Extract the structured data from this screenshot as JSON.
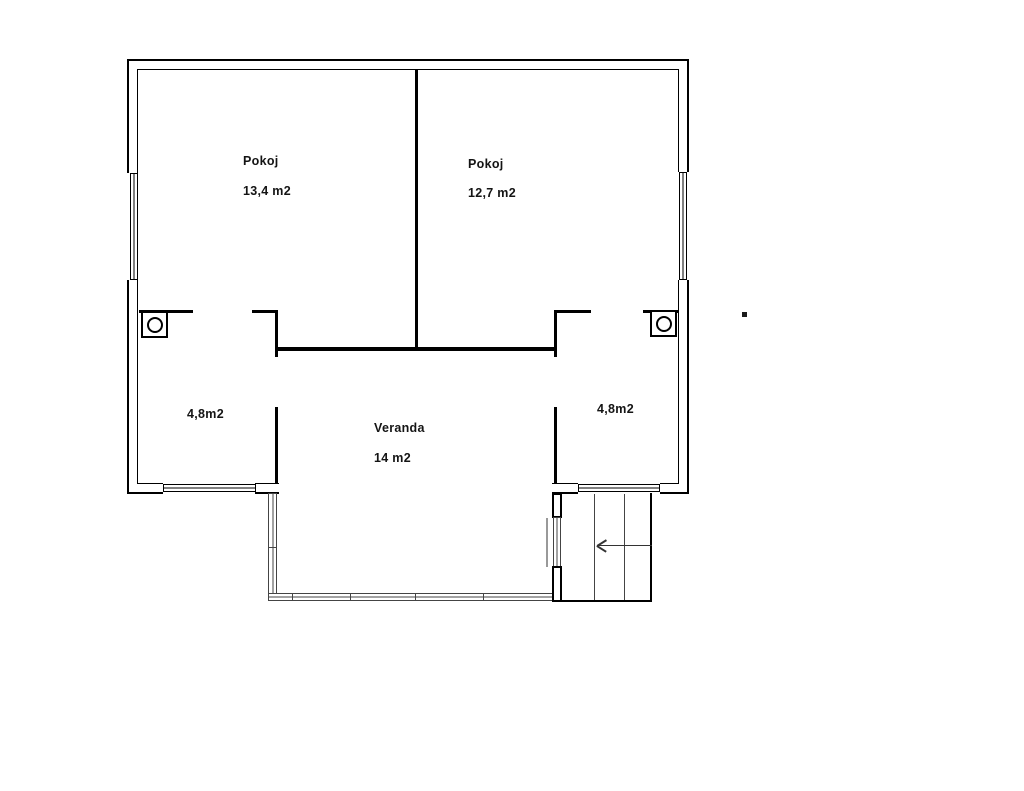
{
  "rooms": {
    "room_left": {
      "name": "Pokoj",
      "area": "13,4 m2"
    },
    "room_right": {
      "name": "Pokoj",
      "area": "12,7 m2"
    },
    "hall_left": {
      "area": "4,8m2"
    },
    "hall_right": {
      "area": "4,8m2"
    },
    "veranda": {
      "name": "Veranda",
      "area": "14 m2"
    }
  },
  "icons": {
    "stove_left": "stove-circle-icon",
    "stove_right": "stove-circle-icon",
    "stairs_arrow": "left-arrow-icon"
  },
  "colors": {
    "wall_line": "#000000",
    "thin_line": "#444444",
    "background": "#ffffff"
  }
}
